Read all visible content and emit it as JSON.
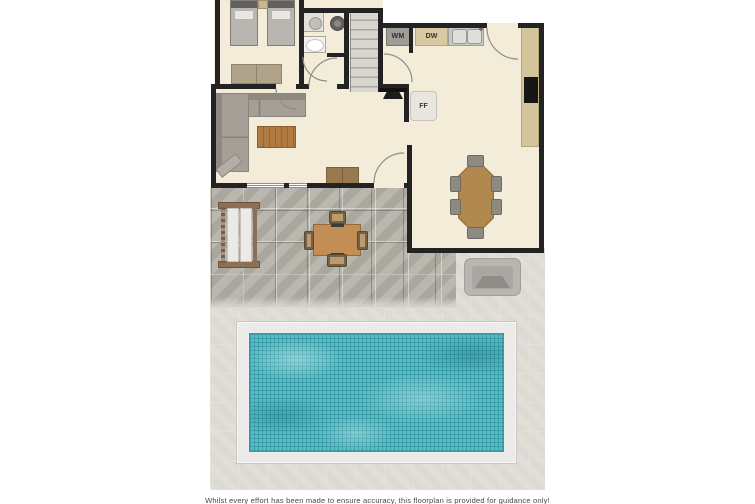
{
  "plan": {
    "title": "ground-floor-plan-with-pool",
    "labels": {
      "washing_machine": "WM",
      "dishwasher": "DW",
      "fridge_freezer": "FF"
    },
    "disclaimer": "Whilst every effort has been made to ensure accuracy, this floorplan is provided for guidance only!",
    "colors": {
      "wall": "#232323",
      "floor": "#f3ecd9",
      "patio_tile": "#b3b0a7",
      "pool_surround_tile": "#dcdad3",
      "pool_water": "#54bcc6",
      "pool_coping": "#ebebe9",
      "appliance_gray": "#9c9c98",
      "counter_tan": "#d8c9a3",
      "wood_furniture": "#b1894f",
      "sofa_gray": "#a59f97"
    }
  }
}
